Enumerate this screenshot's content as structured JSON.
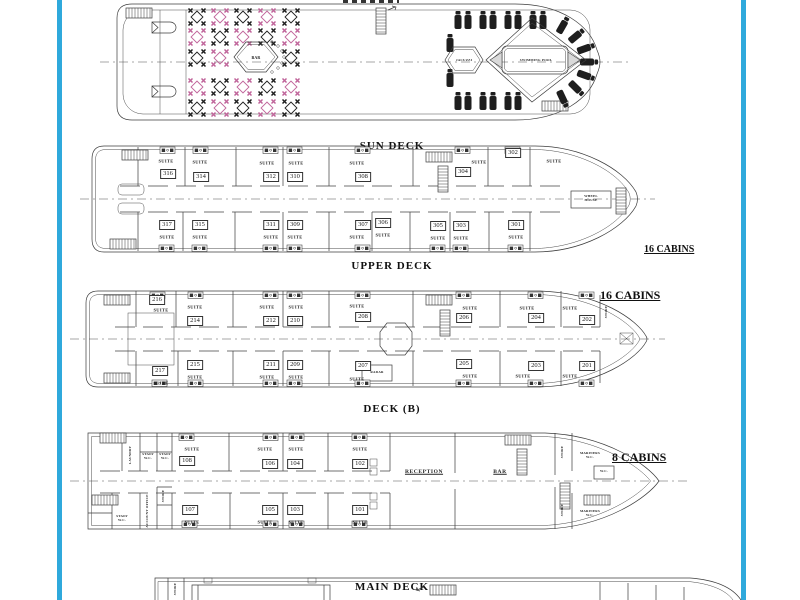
{
  "captions": {
    "sun": "SUN DECK",
    "upper": "UPPER DECK",
    "deckb": "DECK (B)",
    "main": "MAIN DECK"
  },
  "notes": {
    "upper_cabins": "16  CABINS",
    "deckb_cabins": "16  CABINS",
    "main_cabins": "8  CABINS"
  },
  "labels": {
    "suite": "SUITE"
  },
  "sun_deck": {
    "bar": "BAR",
    "jacuzzi": "JACUZZI",
    "pool": "SWIMMING POOL"
  },
  "upper_deck": {
    "wheelhouse": "WHEEL\nHOUSE",
    "cabins_top": [
      "316",
      "314",
      "312",
      "310",
      "308",
      "304",
      "302"
    ],
    "cabins_bottom": [
      "317",
      "315",
      "311",
      "309",
      "307",
      "306",
      "305",
      "303",
      "301"
    ]
  },
  "deck_b": {
    "radar": "RADAR",
    "store": "STORE",
    "cabins_top": [
      "216",
      "214",
      "212",
      "210",
      "208",
      "206",
      "204",
      "202"
    ],
    "cabins_bottom": [
      "217",
      "215",
      "211",
      "209",
      "207",
      "205",
      "203",
      "201"
    ]
  },
  "main_deck": {
    "reception": "RECEPTION",
    "bar": "BAR",
    "laundry": "LAUNDRY",
    "staff_wc": "STAFF\nW.C.",
    "store": "STORE",
    "account_office": "ACCOUNT OFFICE",
    "mariners_wc": "MARINERS\nW.C.",
    "wc": "W.C.",
    "cabins_top": [
      "108",
      "106",
      "104",
      "102"
    ],
    "cabins_bottom": [
      "107",
      "105",
      "103",
      "101"
    ]
  },
  "lower_deck": {
    "store": "STORE"
  },
  "colors": {
    "accent_blue": "#2FA9DC",
    "table_pink": "#C0649A",
    "ink": "#1E1E1E"
  }
}
